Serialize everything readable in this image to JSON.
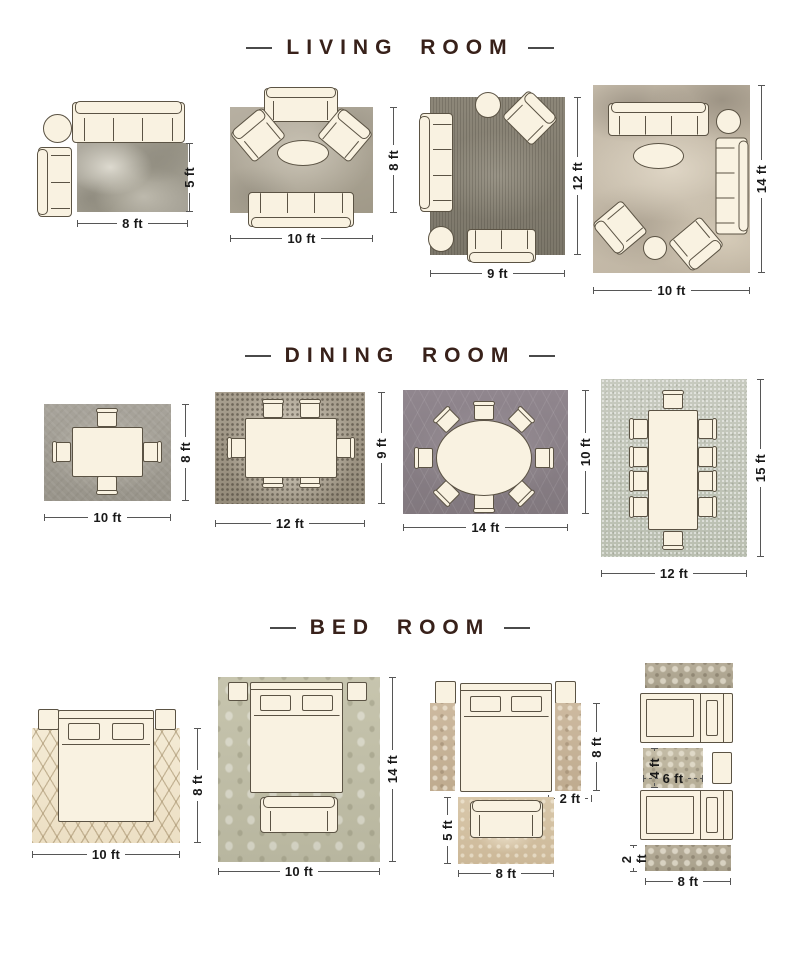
{
  "sections": [
    {
      "title": "LIVING ROOM",
      "layouts": [
        {
          "w": "8 ft",
          "h": "5 ft"
        },
        {
          "w": "10 ft",
          "h": "8 ft"
        },
        {
          "w": "9 ft",
          "h": "12 ft"
        },
        {
          "w": "10 ft",
          "h": "14 ft"
        }
      ]
    },
    {
      "title": "DINING ROOM",
      "layouts": [
        {
          "w": "10 ft",
          "h": "8 ft"
        },
        {
          "w": "12 ft",
          "h": "9 ft"
        },
        {
          "w": "14 ft",
          "h": "10 ft"
        },
        {
          "w": "12 ft",
          "h": "15 ft"
        }
      ]
    },
    {
      "title": "BED ROOM",
      "layouts": [
        {
          "w": "10 ft",
          "h": "8 ft"
        },
        {
          "w": "10 ft",
          "h": "14 ft"
        },
        {
          "runner_h": "8 ft",
          "runner_w": "2 ft",
          "foot_h": "5 ft",
          "foot_w": "8 ft"
        },
        {
          "mid_h": "4 ft",
          "mid_w": "6 ft",
          "runner_h": "2 ft",
          "runner_w": "8 ft"
        }
      ]
    }
  ],
  "colors": {
    "background": "#ffffff",
    "title_text": "#38211a",
    "dimension_line": "#565656",
    "dimension_text": "#191919",
    "furniture_fill": "#f9f2e1",
    "furniture_outline": "#5b5344",
    "rug_living_1": "#a19d92",
    "rug_living_2": "#afa899",
    "rug_living_3": "#86806f",
    "rug_living_4": "#c4b9a6",
    "rug_dining_1": "#a39f96",
    "rug_dining_2": "#9f9686",
    "rug_dining_3": "#8b8188",
    "rug_dining_4": "#c2c5ba",
    "rug_bed_1": "#f1e7d1",
    "rug_bed_2": "#c2c0a9",
    "rug_bed_3_runner": "#c8b59b",
    "rug_bed_3_foot": "#d5c3a6",
    "rug_bed_4_runner": "#b1a894",
    "rug_bed_4_mid": "#c0b8a2"
  }
}
